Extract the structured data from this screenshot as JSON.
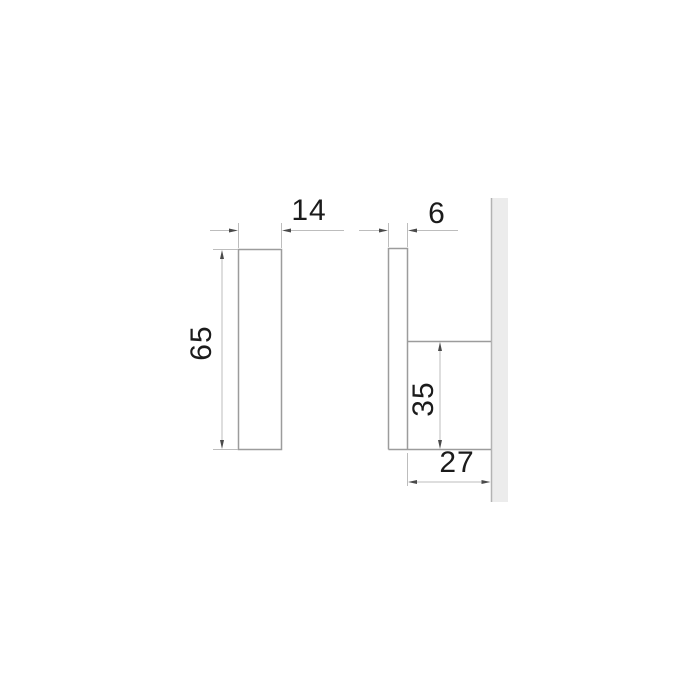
{
  "drawing": {
    "kind": "technical-dimension-drawing",
    "subject": "wall-mounted hook, two orthographic views with millimeter dimensions",
    "views": {
      "front": {
        "name": "front view",
        "dimensions": {
          "width": "14",
          "height": "65"
        }
      },
      "side": {
        "name": "side view",
        "dimensions": {
          "thickness": "6",
          "bracket_height": "35",
          "depth": "27"
        }
      }
    }
  },
  "colors": {
    "background": "#ffffff",
    "outline": "#9c9c9c",
    "dimension_line": "#bdbdbd",
    "arrow": "#4a4a4a",
    "label_text": "#1b1b1b",
    "wall_fill": "#ececec",
    "wall_edge": "#b3b3b3"
  }
}
